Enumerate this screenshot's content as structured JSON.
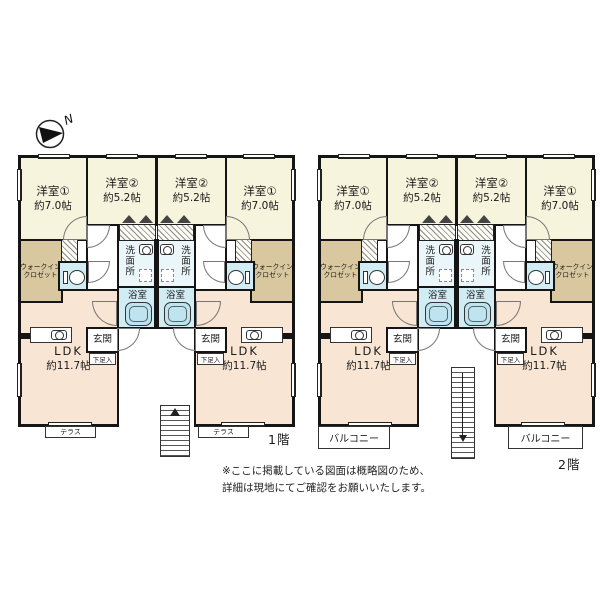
{
  "compass": {
    "north": "N"
  },
  "rooms": {
    "bedroom_a": {
      "name": "洋室①",
      "size": "約7.0帖"
    },
    "bedroom_b": {
      "name": "洋室②",
      "size": "約5.2帖"
    },
    "ldk": {
      "name": "LDK",
      "size": "約11.7帖"
    },
    "walk_in_closet": {
      "line1": "ウォークイン",
      "line2": "クロゼット"
    },
    "washroom": "洗面所",
    "bathroom": "浴室",
    "entrance": "玄関",
    "shoe_cabinet": "下足入",
    "terrace": "テラス",
    "balcony": "バルコニー"
  },
  "floors": {
    "first": "1階",
    "second": "2階"
  },
  "note": {
    "line1": "※ここに掲載している図面は概略図のため、",
    "line2": "詳細は現地にてご確認をお願いいたします。"
  },
  "colors": {
    "wall": "#151515",
    "bedroom": "#f7f4dd",
    "ldk": "#f9e5d4",
    "closet": "#d9c79f",
    "wet_room": "#d2ecf4",
    "washroom": "#eaf6f9",
    "background": "#ffffff"
  }
}
